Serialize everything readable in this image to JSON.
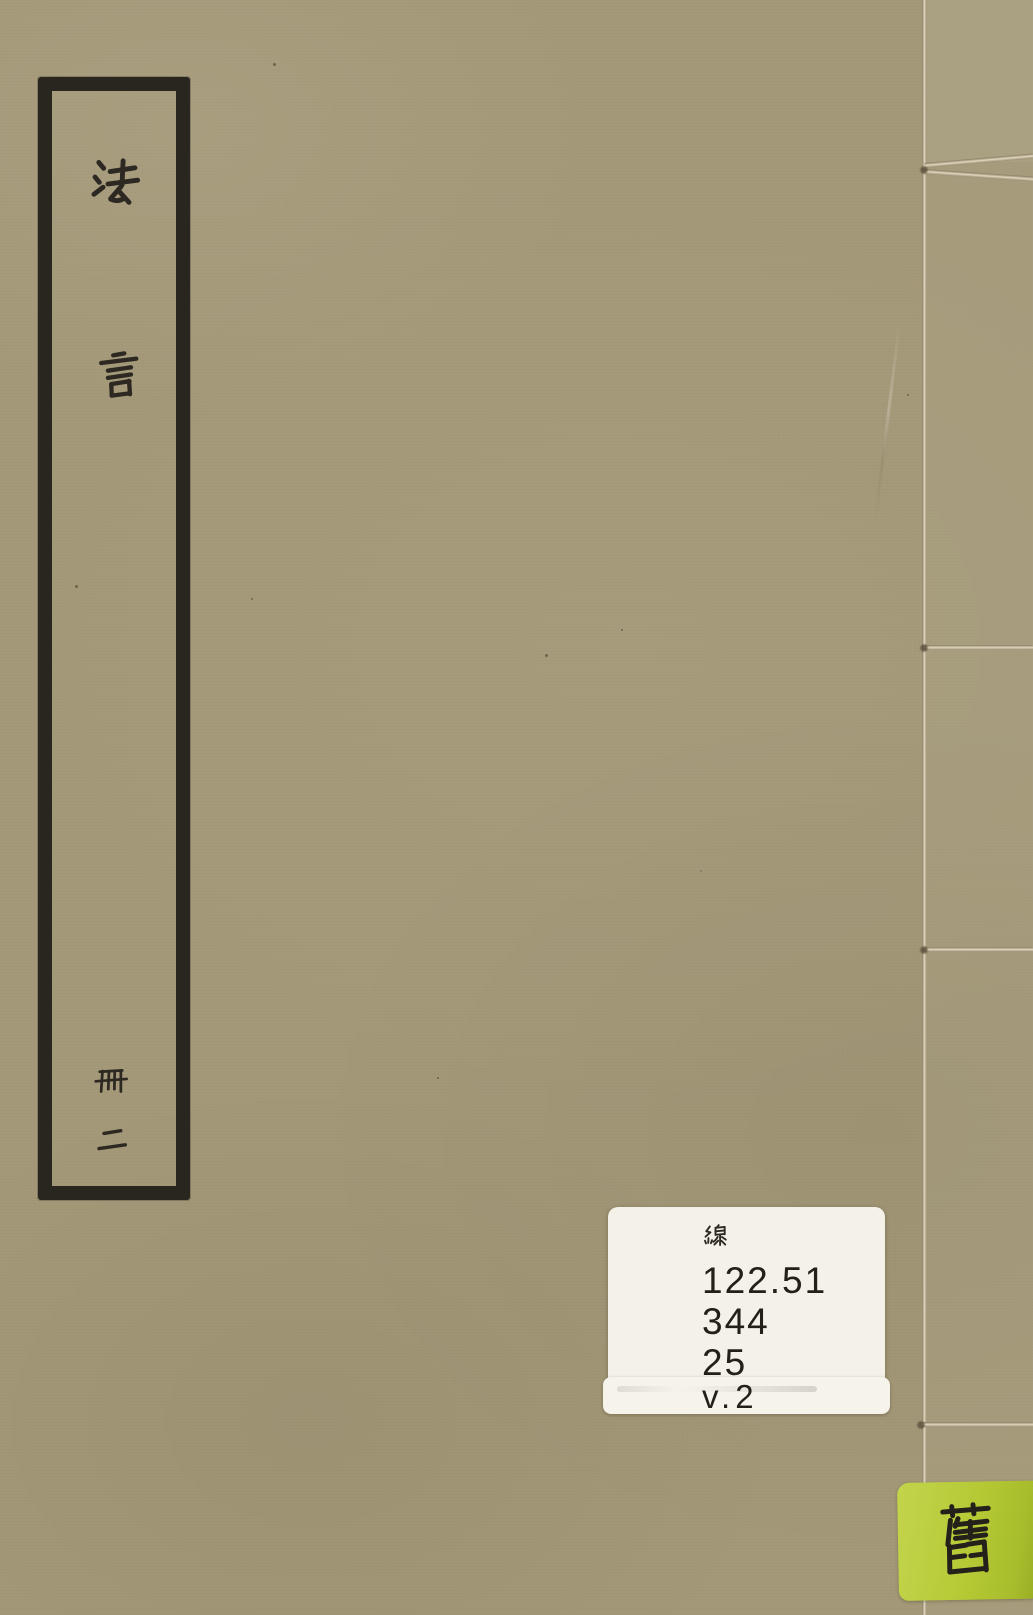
{
  "scene": {
    "description": "Front cover of an old thread-bound Chinese book (volume 2)",
    "cover_color": "#a39877",
    "frame_color": "#29251f",
    "thread_color": "#ddd4ba"
  },
  "title_slip": {
    "title": "法言",
    "char_1": "法",
    "char_2": "言",
    "volume": "冊二",
    "volume_char_1": "冊",
    "volume_char_2": "二"
  },
  "call_number_label": {
    "background_color": "#f4f1e9",
    "script_line": "線",
    "lines": [
      "122.51",
      "344",
      "25"
    ]
  },
  "volume_sticker": {
    "background_color": "#f6f3eb",
    "text": "v.2"
  },
  "condition_sticker": {
    "background_color": "#b5c935",
    "char": "舊"
  }
}
